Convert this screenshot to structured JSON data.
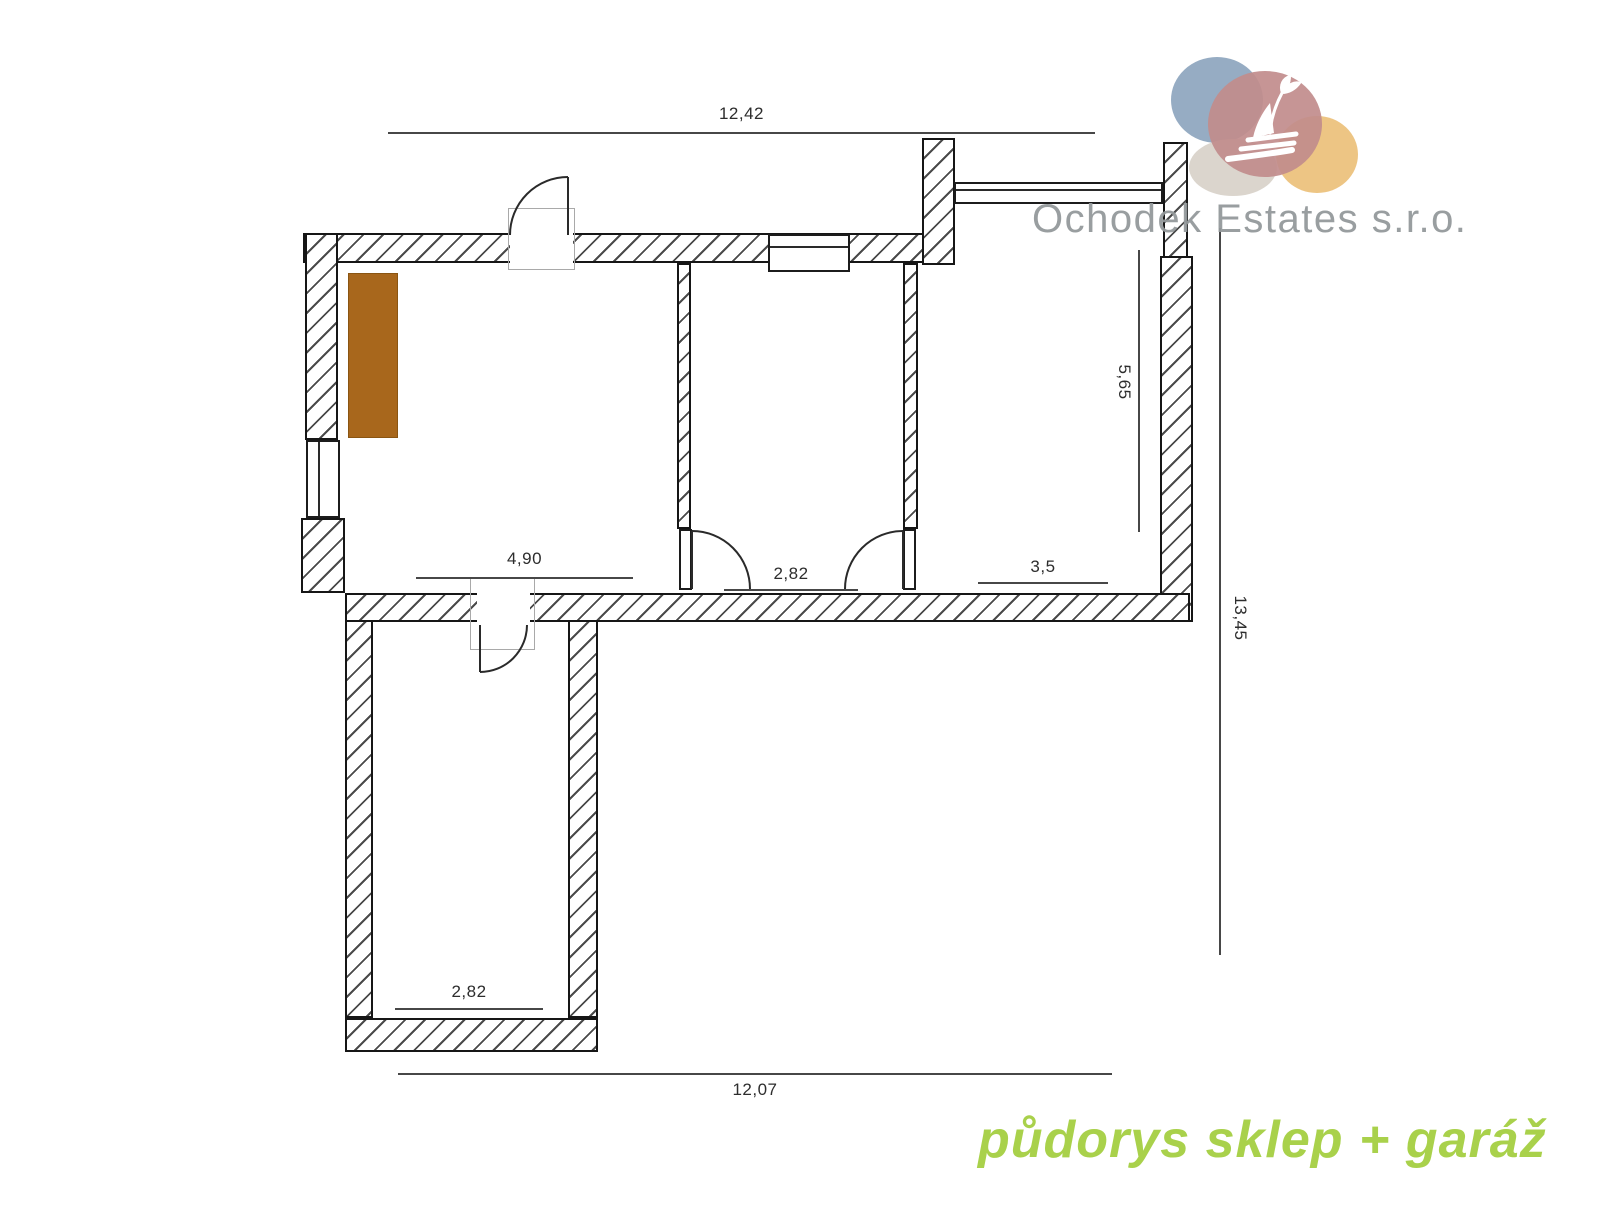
{
  "plan": {
    "dimensions": {
      "top_width": "12,42",
      "left_room_width": "4,90",
      "middle_room_width": "2,82",
      "right_room_width": "3,5",
      "right_room_height": "5,65",
      "overall_height": "13,45",
      "garage_width": "2,82",
      "bottom_width": "12,07"
    },
    "furniture_color": "#a8671c",
    "wall_hatch_color": "#4a4a4a"
  },
  "logo": {
    "company": "Ochodek Estates s.r.o.",
    "mark": "sailboat-swan-icon",
    "text_color": "#94999b",
    "blob_colors": {
      "blue": "#8ba3bd",
      "red": "#c18c8c",
      "beige": "#d9d3ca",
      "yellow": "#ecc27d"
    }
  },
  "caption": {
    "text": "půdorys sklep + garáž",
    "color": "#a9d14b"
  }
}
